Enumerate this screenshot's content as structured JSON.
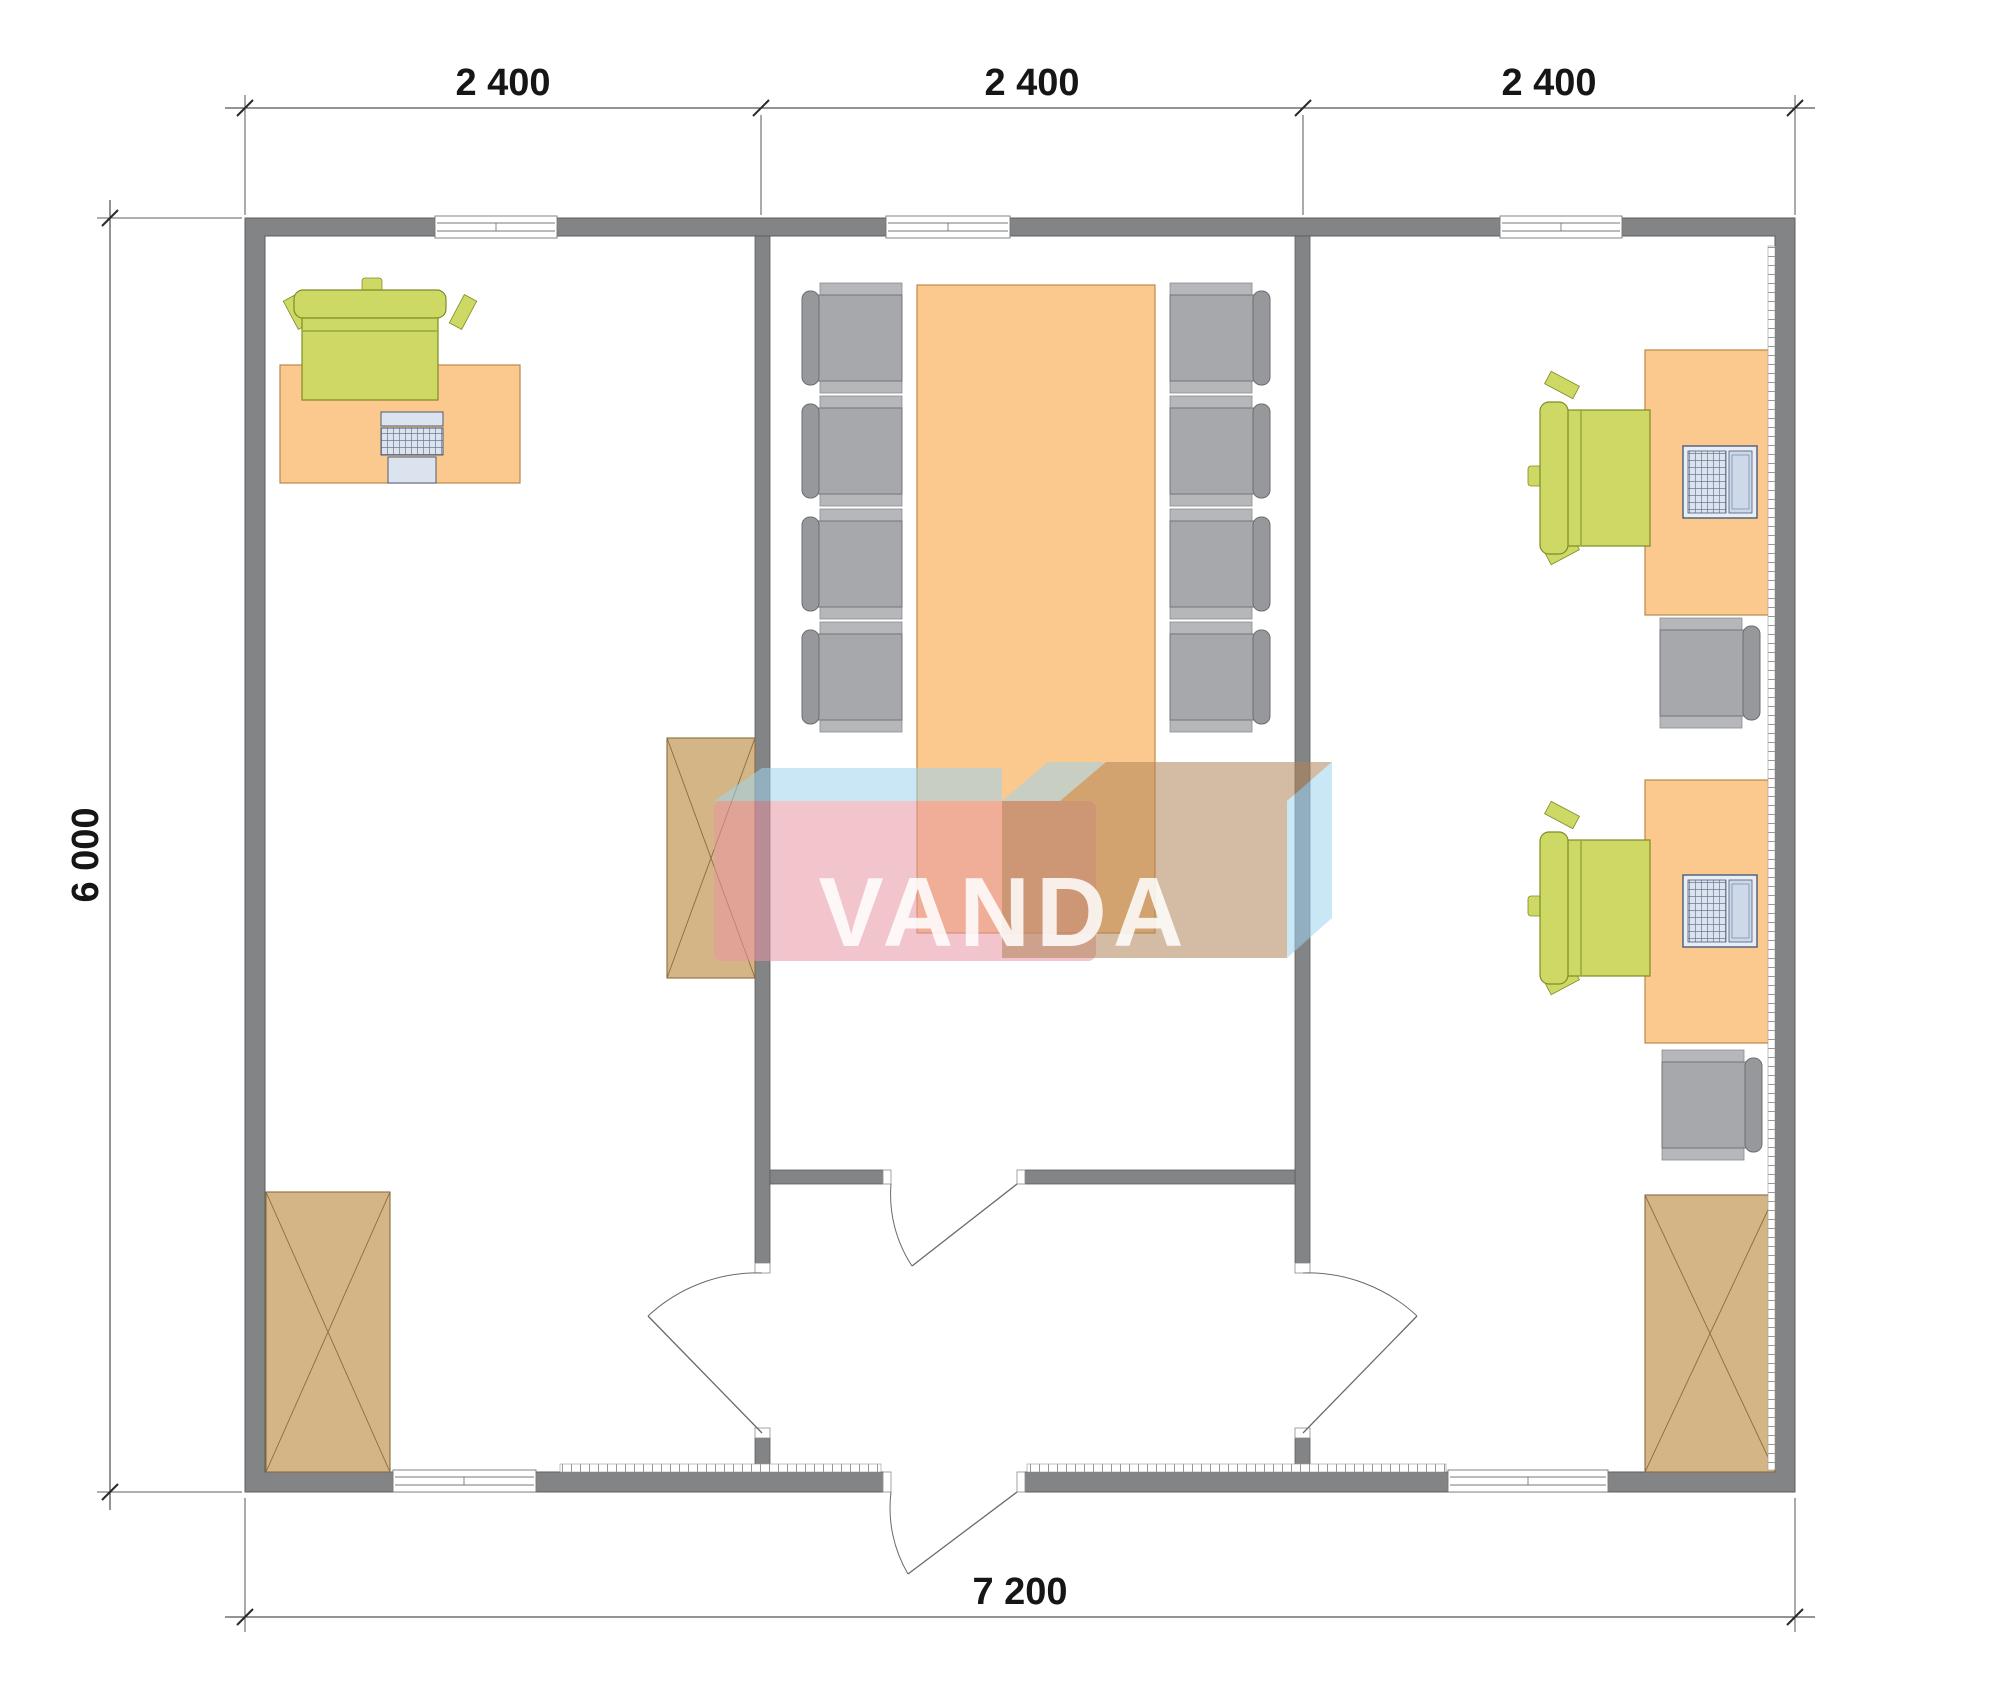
{
  "drawing": {
    "type": "architectural floor plan, top view, 3-room modular office building",
    "watermark": {
      "text": "VANDA"
    },
    "dimensions": {
      "top": [
        "2 400",
        "2 400",
        "2 400"
      ],
      "side": "6 000",
      "bottom": "7 200"
    },
    "rooms": [
      {
        "name": "left office",
        "furniture": [
          "desk with keyboard computer",
          "green office chair",
          "tall wardrobe cabinet",
          "corner wardrobe cabinet"
        ]
      },
      {
        "name": "conference room",
        "furniture": [
          "conference table",
          "8 gray armchairs"
        ]
      },
      {
        "name": "right office",
        "furniture": [
          "2 desks with laptops",
          "2 green office chairs",
          "2 gray armchairs",
          "wardrobe cabinet"
        ]
      },
      {
        "name": "entrance vestibule",
        "furniture": [
          "4 swing doors"
        ]
      }
    ],
    "palette": {
      "wall": "#828486",
      "wall_outline": "#5c5e60",
      "desk": "#fbc98d",
      "desk_outline": "#b9884a",
      "cabinet": "#d4b586",
      "cabinet_outline": "#8a6c42",
      "chair_gray": "#a6a8ab",
      "chair_green": "#cdd964",
      "chair_green_outline": "#7f8c26",
      "device": "#dbe4ee",
      "device_outline": "#4c5a78",
      "door_line": "#6a6a6a",
      "dim_line": "#2a2a2a",
      "wm_pink": "#e895a3",
      "wm_tan": "#b08457",
      "wm_blue": "#9fd4ee",
      "wm_text": "#ffffff"
    }
  }
}
